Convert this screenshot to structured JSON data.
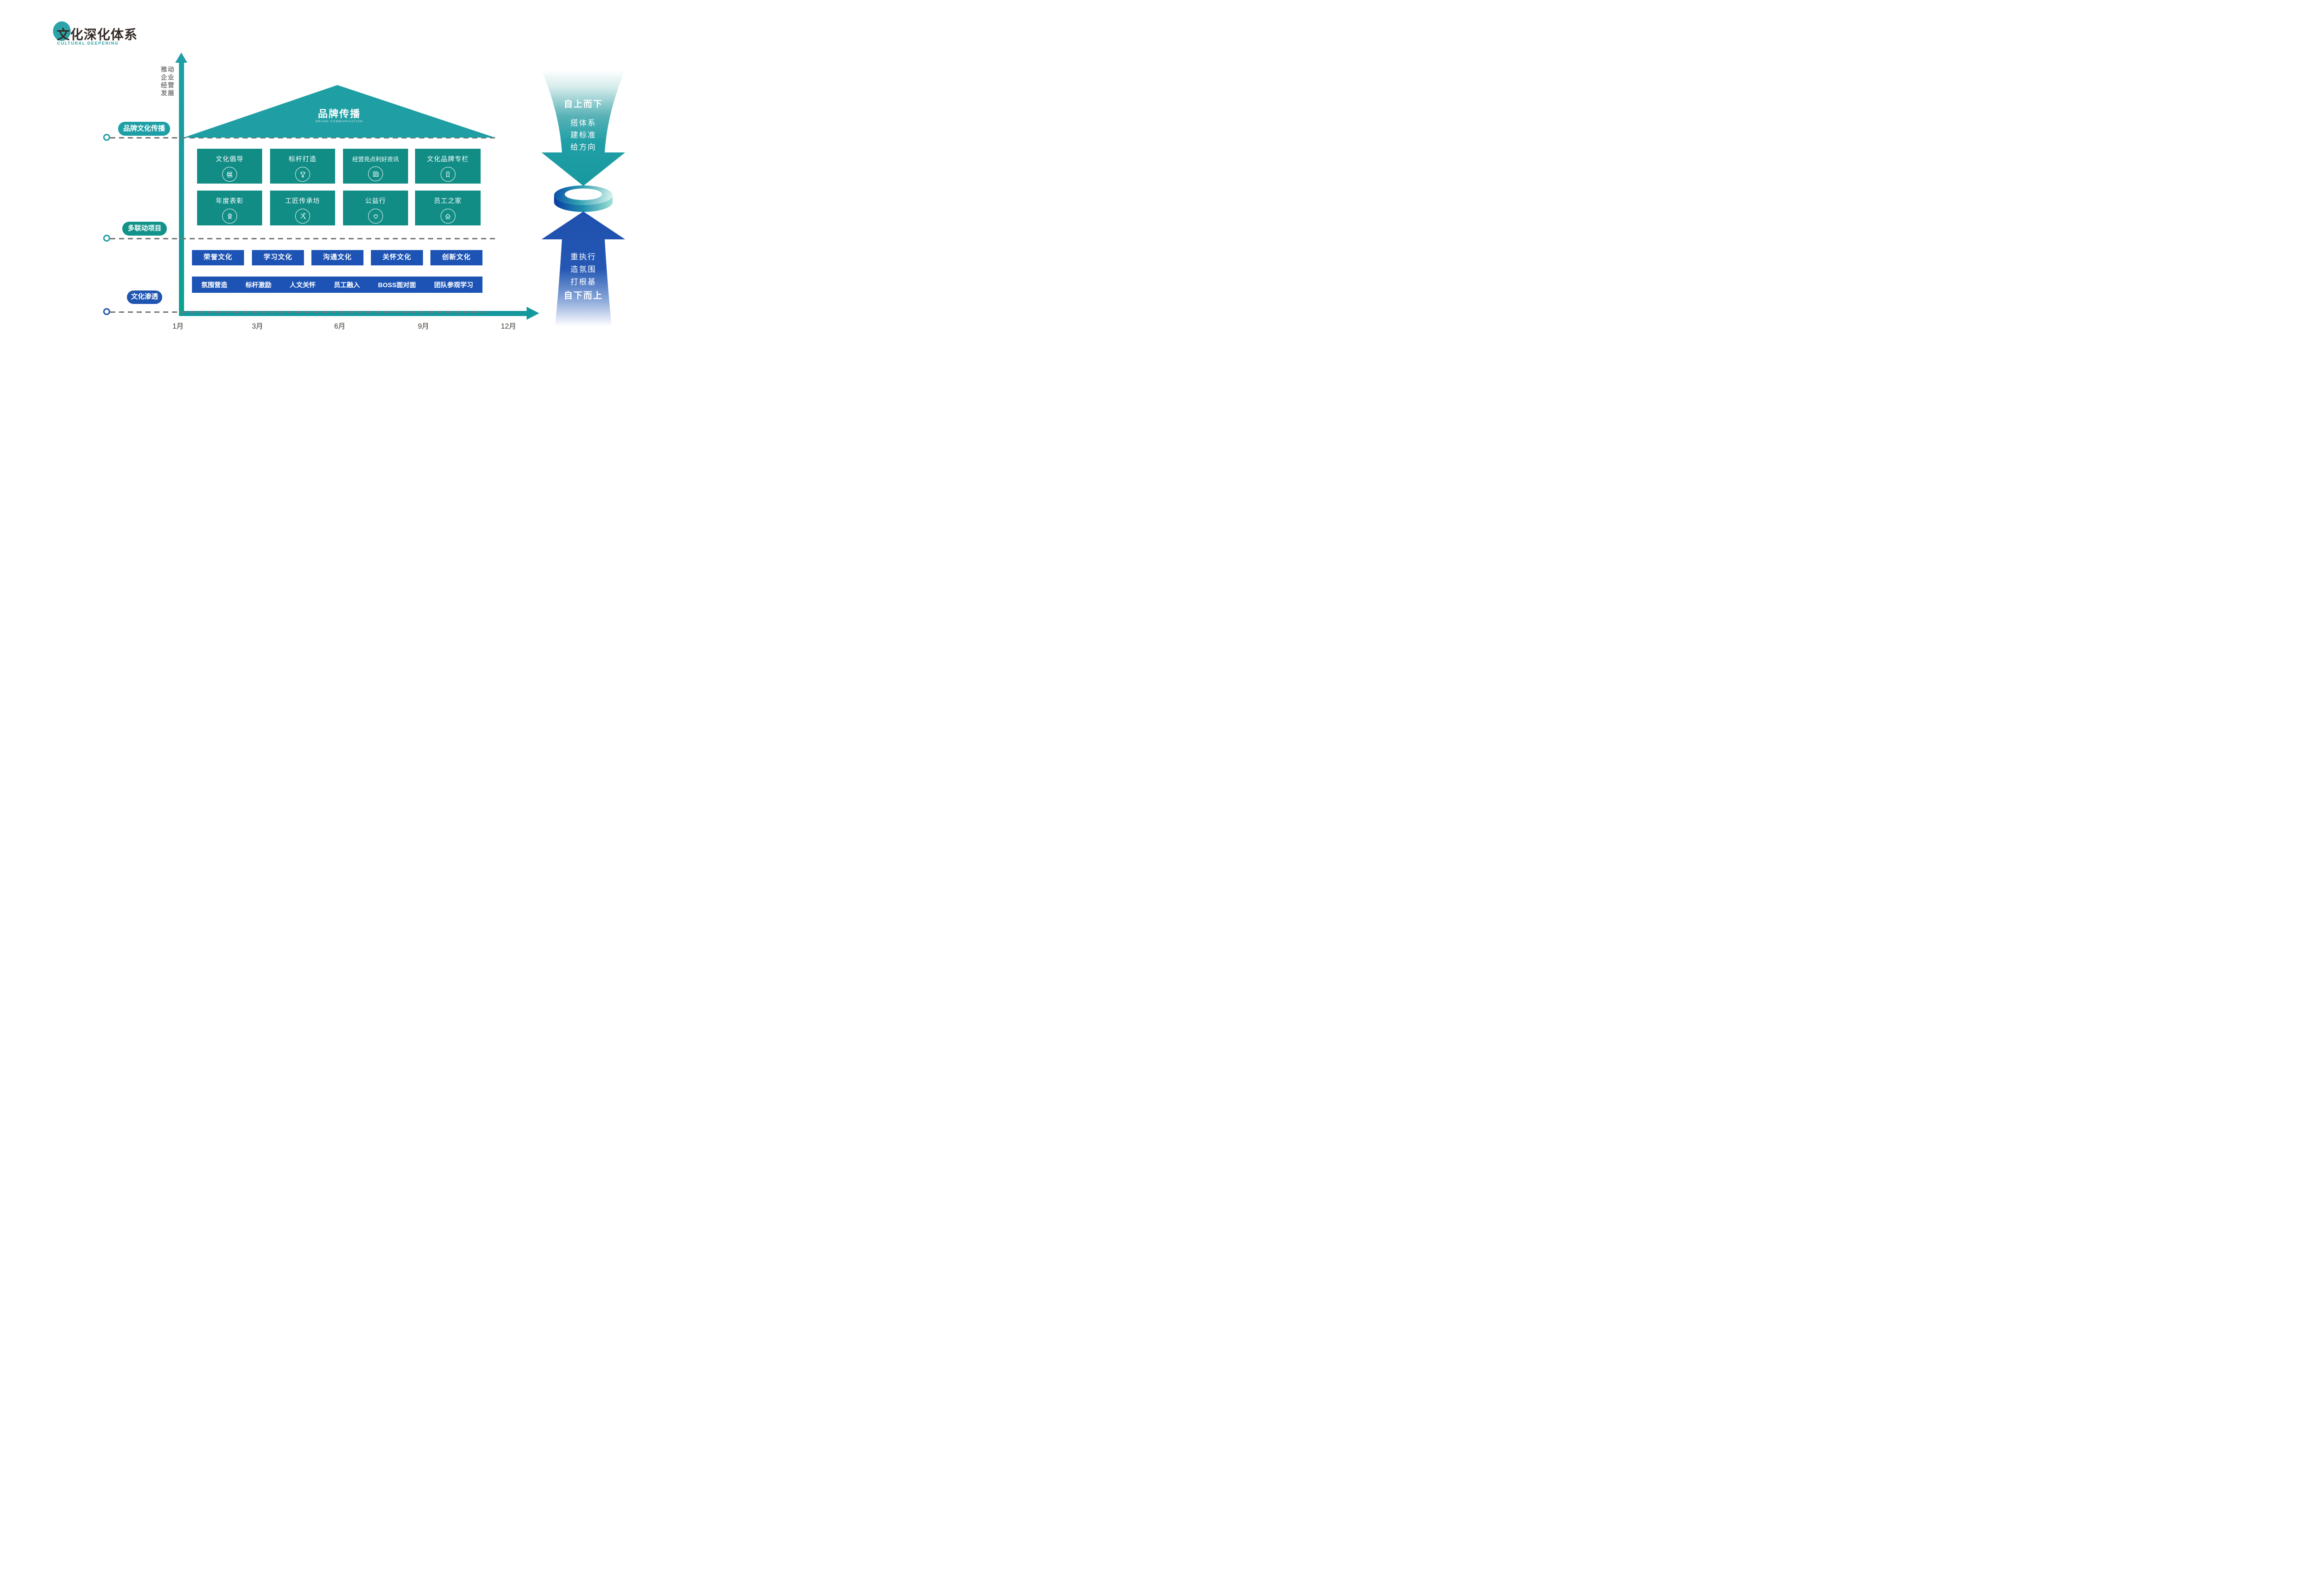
{
  "logo": {
    "title": "文化深化体系",
    "subtitle": "CULTURAL DEEPENING"
  },
  "y_axis": {
    "label_lines": [
      "推动",
      "企业",
      "经营",
      "发展"
    ]
  },
  "x_axis": {
    "months": [
      "1月",
      "3月",
      "6月",
      "9月",
      "12月"
    ]
  },
  "row_labels": [
    {
      "label": "品牌文化传播"
    },
    {
      "label": "多联动项目"
    },
    {
      "label": "文化渗透"
    }
  ],
  "roof": {
    "title": "品牌传播",
    "subtitle": "BRAND COMMUNICATION"
  },
  "program_boxes": {
    "row1": [
      {
        "label": "文化倡导",
        "icon": "books-icon"
      },
      {
        "label": "标杆打造",
        "icon": "trophy-icon"
      },
      {
        "label": "经营亮点利好资讯",
        "icon": "news-icon"
      },
      {
        "label": "文化品牌专栏",
        "icon": "bookmark-icon"
      }
    ],
    "row2": [
      {
        "label": "年度表彰",
        "icon": "medal-icon"
      },
      {
        "label": "工匠传承坊",
        "icon": "tools-icon"
      },
      {
        "label": "公益行",
        "icon": "heart-icon"
      },
      {
        "label": "员工之家",
        "icon": "home-icon"
      }
    ]
  },
  "culture_boxes": [
    "荣誉文化",
    "学习文化",
    "沟通文化",
    "关怀文化",
    "创新文化"
  ],
  "penetration_items": [
    "氛围营造",
    "标杆激励",
    "人文关怀",
    "员工融入",
    "BOSS面对面",
    "团队参观学习"
  ],
  "down_arrow": {
    "headline": "自上而下",
    "lines": [
      "搭体系",
      "建标准",
      "给方向"
    ]
  },
  "up_arrow": {
    "lines": [
      "重执行",
      "造氛围",
      "打根基"
    ],
    "headline": "自下而上"
  },
  "colors": {
    "teal": "#1E9EA6",
    "teal_box": "#118D86",
    "teal_pill_dark": "#12938A",
    "blue": "#1C53B4",
    "blue_pill": "#1F55B0",
    "blue_arrow": "#2154AE",
    "dash_gray": "#767676",
    "text_dark": "#332B27",
    "axis_label_gray": "#7A7A7A"
  }
}
